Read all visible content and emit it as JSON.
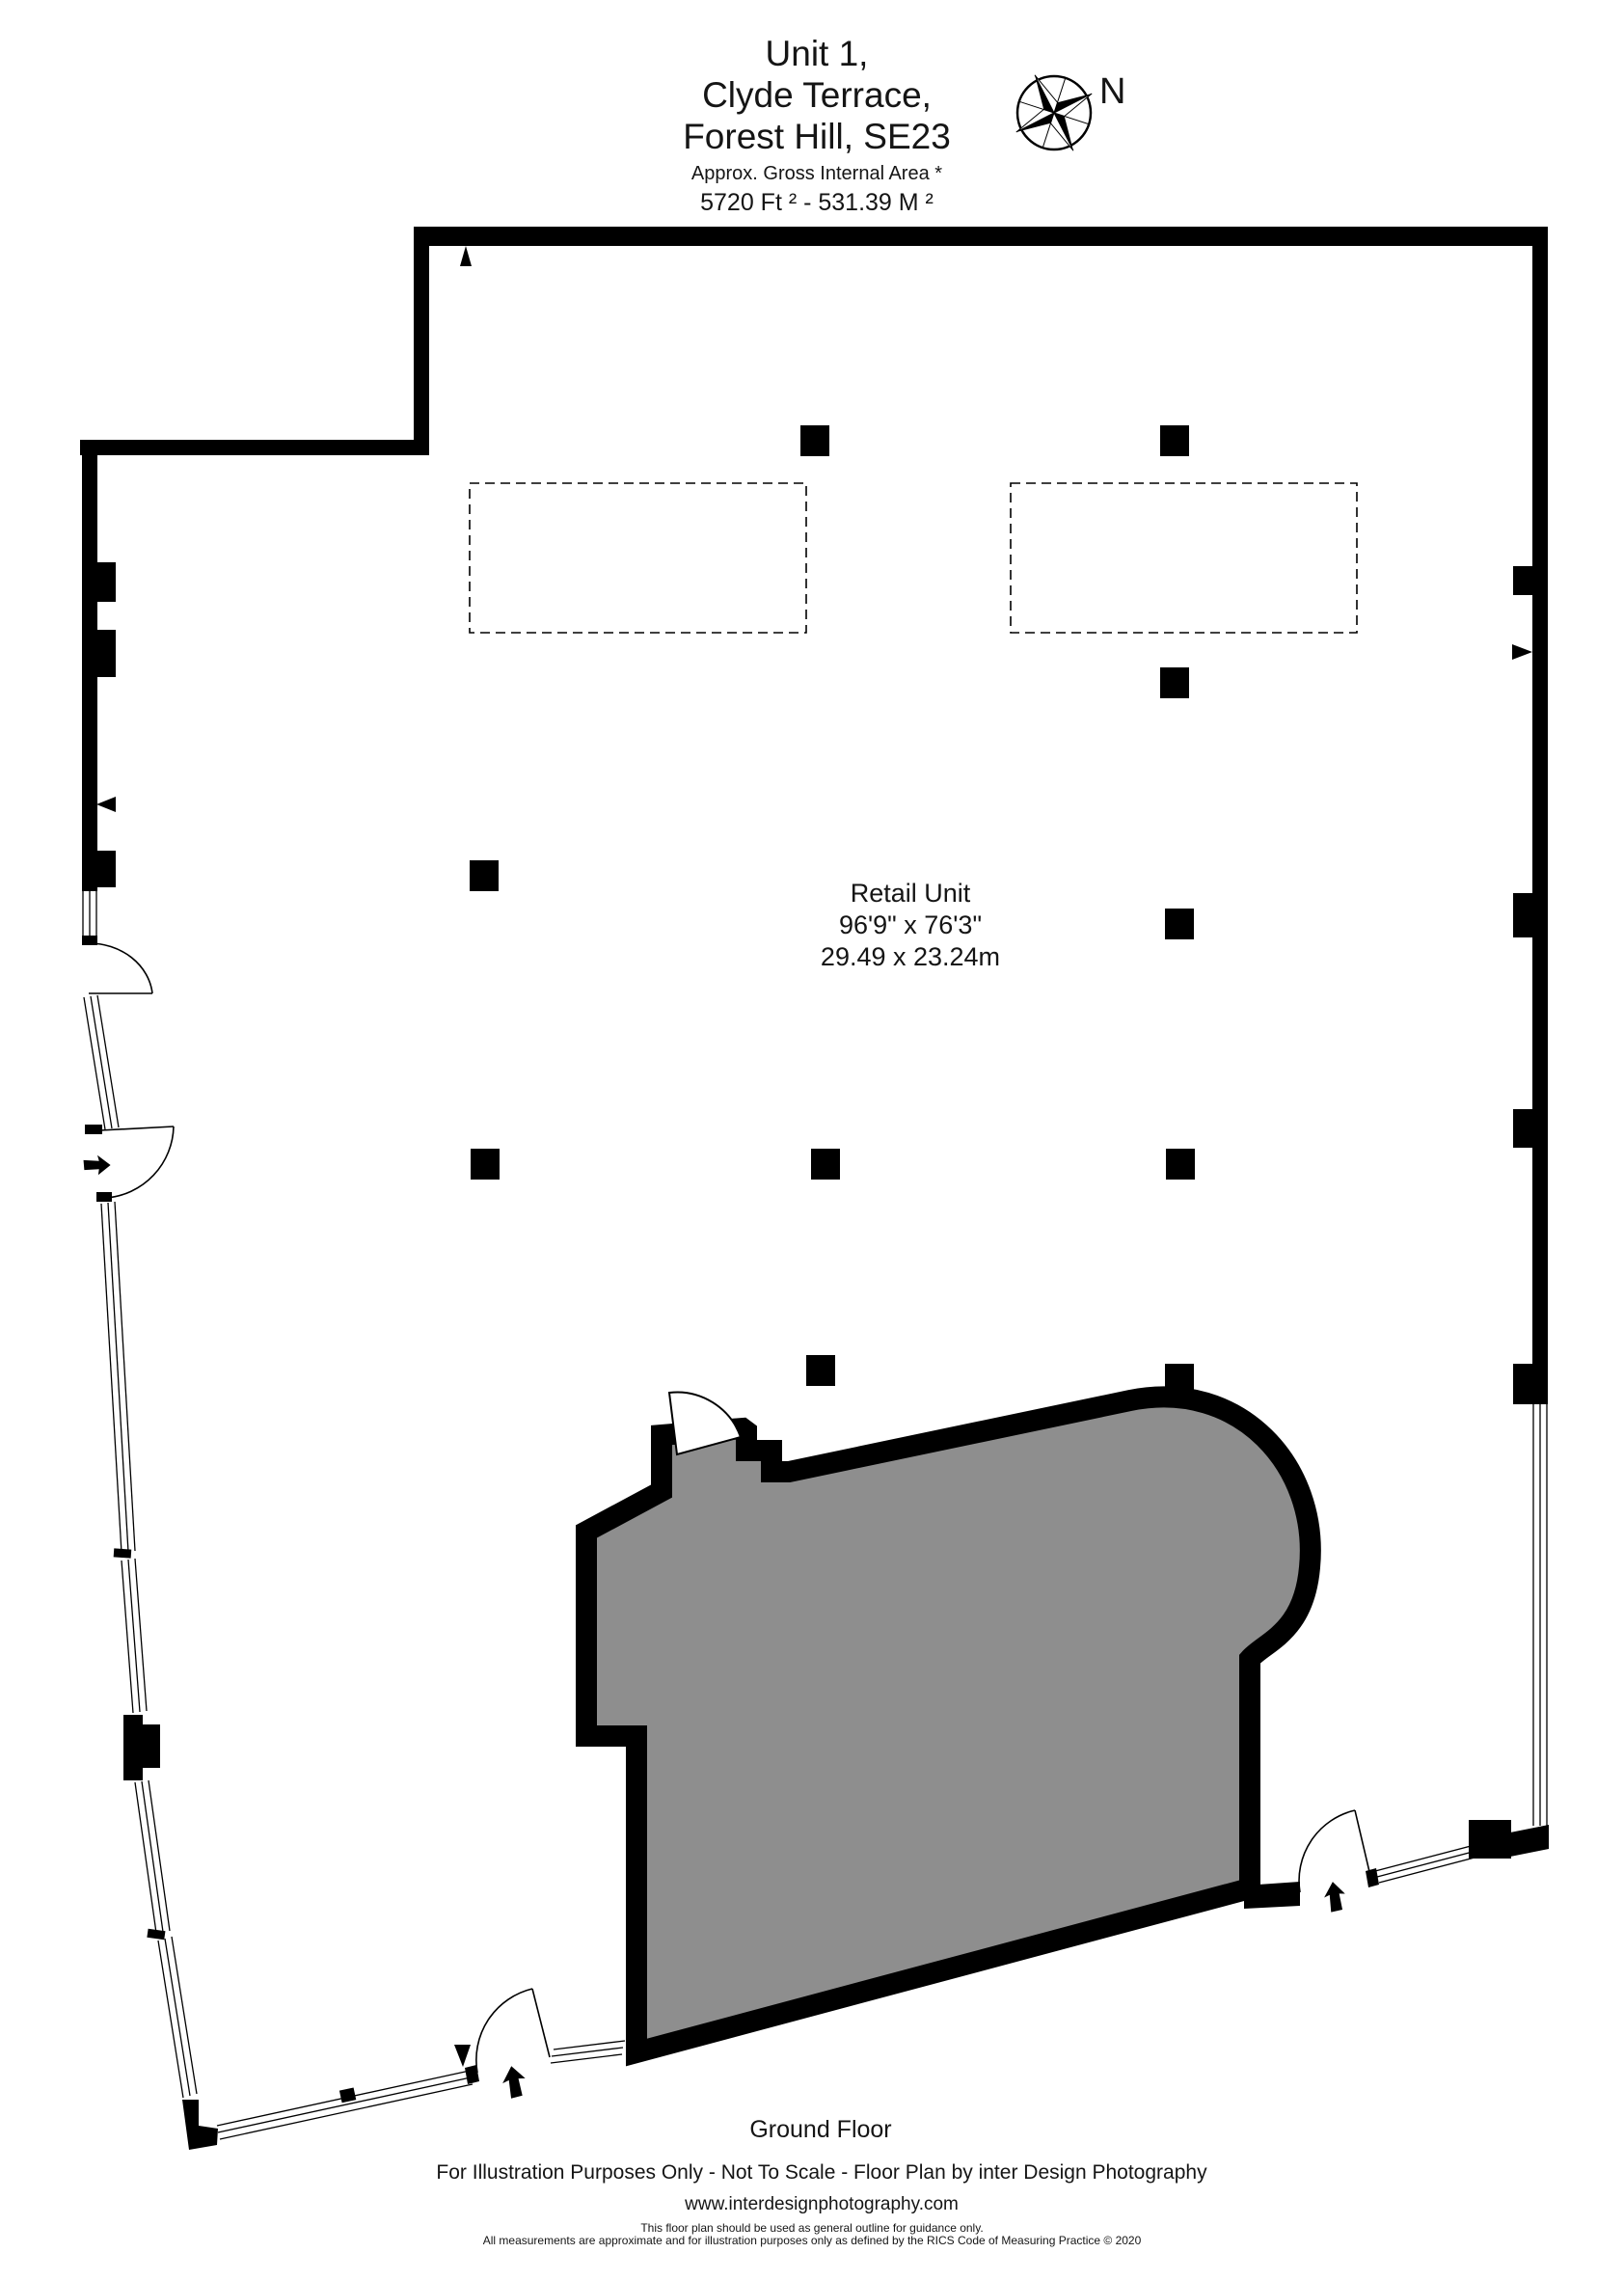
{
  "title": {
    "line1": "Unit 1,",
    "line2": "Clyde Terrace,",
    "line3": "Forest Hill, SE23",
    "area_label": "Approx. Gross Internal Area *",
    "area_value": "5720 Ft ²  -  531.39 M ²"
  },
  "compass": {
    "label": "N"
  },
  "room": {
    "name": "Retail Unit",
    "dimensions_imperial": "96'9\" x 76'3\"",
    "dimensions_metric": "29.49 x 23.24m"
  },
  "floor": {
    "label": "Ground Floor"
  },
  "footer": {
    "line1": "For Illustration Purposes Only - Not To Scale - Floor Plan by inter Design Photography",
    "website": "www.interdesignphotography.com",
    "disclaimer1": "This floor plan should be used as general outline for guidance only.",
    "disclaimer2": "All measurements are approximate and for illustration purposes only as defined by the RICS Code of Measuring Practice © 2020"
  },
  "colors": {
    "wall": "#000000",
    "shaded_area": "#8e8e8e",
    "background": "#ffffff"
  }
}
